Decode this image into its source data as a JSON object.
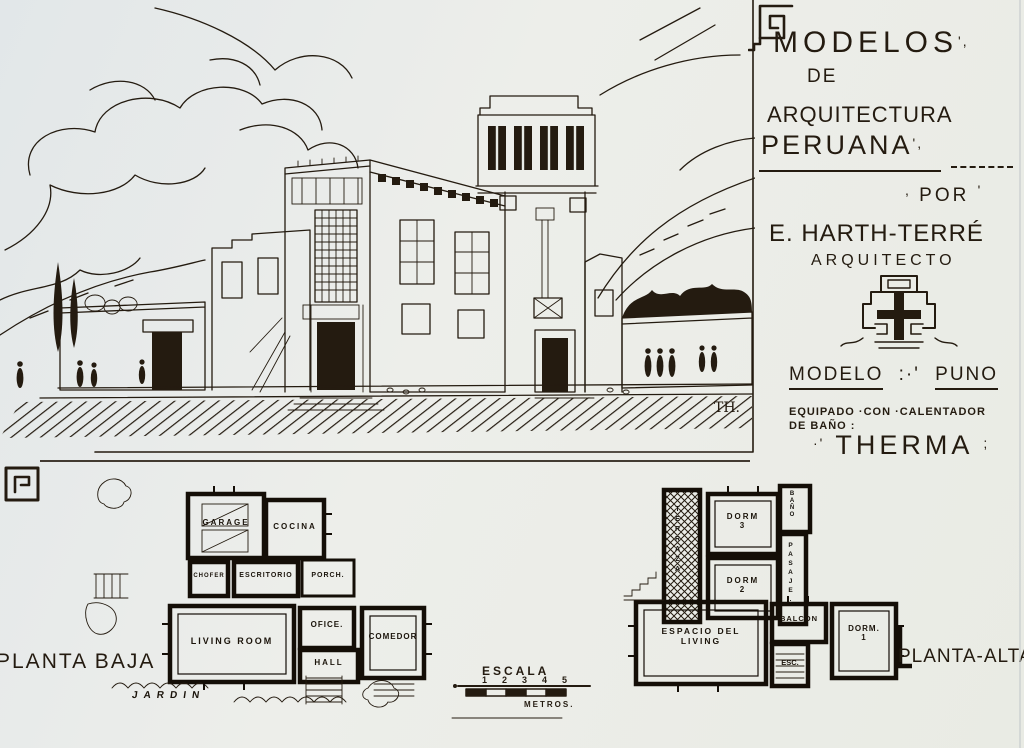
{
  "colors": {
    "paper": "#e9ebe6",
    "ink": "#241b10",
    "wall": "#140e07"
  },
  "title_block": {
    "line1": "MODELOS",
    "line1_marks": "',",
    "line2": "DE",
    "line3": "ARQUITECTURA",
    "line4": "PERUANA",
    "line4_marks": "',",
    "por_prefix": ",",
    "por": "POR",
    "por_suffix": "'",
    "architect_name": "E. HARTH-TERRÉ",
    "architect_title": "ARQUITECTO",
    "model_label": "MODELO",
    "model_sep": ":·'",
    "model_value": "PUNO",
    "equip_line1": "EQUIPADO ·CON ·CALENTADOR",
    "equip_line2": "DE BAÑO :",
    "brand_prefix": "·'",
    "brand": "THERMA",
    "brand_suffix": ";"
  },
  "sketch": {
    "signature": "TH."
  },
  "planta_baja": {
    "title": "PLANTA BAJA",
    "rooms": {
      "garage": "GARAGE",
      "cocina": "COCINA",
      "chofer": "CHOFER",
      "escritorio": "ESCRITORIO",
      "porch": "PORCH.",
      "living": "LIVING ROOM",
      "ofice": "OFICE.",
      "comedor": "COMEDOR",
      "hall": "HALL",
      "jardin": "JARDIN"
    }
  },
  "planta_alta": {
    "title": "PLANTA-ALTA.",
    "rooms": {
      "terraza": "TERRAZA",
      "dorm3_l1": "DORM",
      "dorm3_l2": "3",
      "dorm2_l1": "DORM",
      "dorm2_l2": "2",
      "bano": "BAÑO",
      "pasaje": "PASAJE.",
      "espacio_l1": "ESPACIO DEL",
      "espacio_l2": "LIVING",
      "balcon": "BALCON",
      "dorm1_l1": "DORM.",
      "dorm1_l2": "1",
      "esc": "ESC."
    }
  },
  "scale": {
    "label": "ESCALA",
    "ticks": [
      "1",
      "2",
      "3",
      "4",
      "5"
    ],
    "unit": "METROS."
  }
}
